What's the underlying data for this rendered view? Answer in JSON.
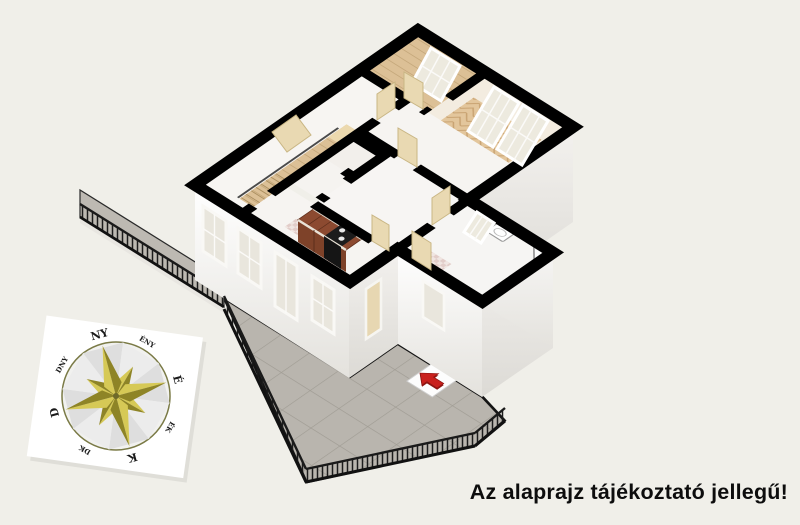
{
  "image": {
    "background": "#f0efe9"
  },
  "disclaimer": {
    "text": "Az alaprajz tájékoztató jellegű!",
    "color": "#0d0d0d"
  },
  "compass": {
    "rotation_deg": 75,
    "labels": {
      "n": "É",
      "ne": "ÉK",
      "e": "K",
      "se": "DK",
      "s": "D",
      "sw": "DNY",
      "w": "NY",
      "nw": "ÉNY"
    },
    "star_light": "#d6c956",
    "star_dark": "#8e8426",
    "ring_color": "#7a7a46",
    "card_color": "#ffffff"
  },
  "floorplan": {
    "wall_color": "#000000",
    "floor_wood": "#dcc096",
    "floor_herringbone": "#e3c69c",
    "terrace_tile": "#b9b5ae",
    "kitchen_cabinet": "#8c4a30",
    "stove_color": "#1c1c1c",
    "door_color": "#e9d9b2",
    "entrance_arrow": "#c9201d",
    "features": [
      "staircase",
      "kitchen-counter",
      "stove",
      "herringbone-parquet-room",
      "plank-floor-room",
      "hall",
      "closet",
      "bathroom-annex",
      "bathroom-sink",
      "corner-shower",
      "terrace",
      "terrace-railing",
      "walkway",
      "entrance-arrow-tile",
      "windows",
      "interior-doors"
    ]
  }
}
